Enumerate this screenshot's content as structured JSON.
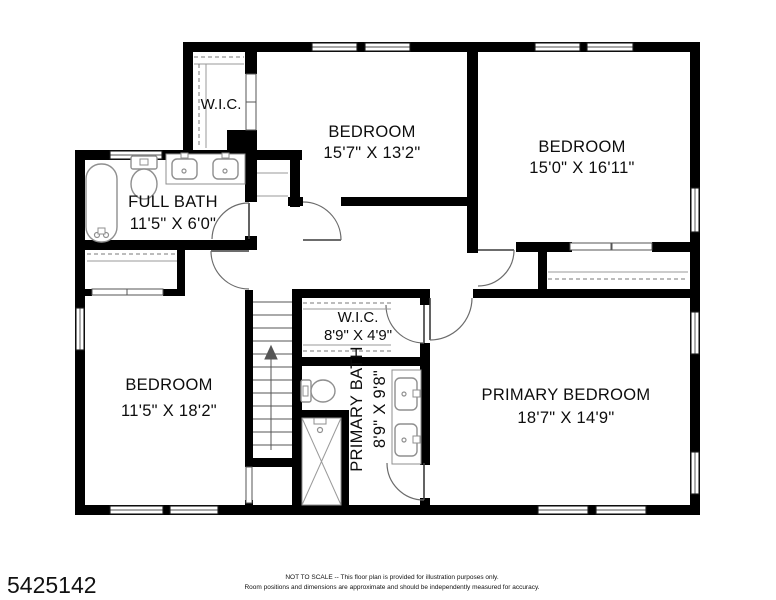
{
  "listing_id": "5425142",
  "colors": {
    "walls": "#000000",
    "background": "#ffffff",
    "fixture_line": "#8f8f8f"
  },
  "rooms": {
    "wic_upper": {
      "label": "W.I.C."
    },
    "bedroom_top": {
      "label": "BEDROOM",
      "dims": "15'7\" X 13'2\""
    },
    "bedroom_right": {
      "label": "BEDROOM",
      "dims": "15'0\" X 16'11\""
    },
    "full_bath": {
      "label": "FULL BATH",
      "dims": "11'5\" X 6'0\""
    },
    "bedroom_left": {
      "label": "BEDROOM",
      "dims": "11'5\" X 18'2\""
    },
    "wic_primary": {
      "label": "W.I.C.",
      "dims": "8'9\" X 4'9\""
    },
    "primary_bath": {
      "label": "PRIMARY BATH",
      "dims": "8'9\" X 9'8\""
    },
    "primary_bedroom": {
      "label": "PRIMARY BEDROOM",
      "dims": "18'7\" X 14'9\""
    }
  },
  "disclaimer": {
    "line1": "NOT TO SCALE -- This floor plan is provided for illustration purposes only.",
    "line2": "Room positions and dimensions are approximate and should be independently measured for accuracy."
  }
}
